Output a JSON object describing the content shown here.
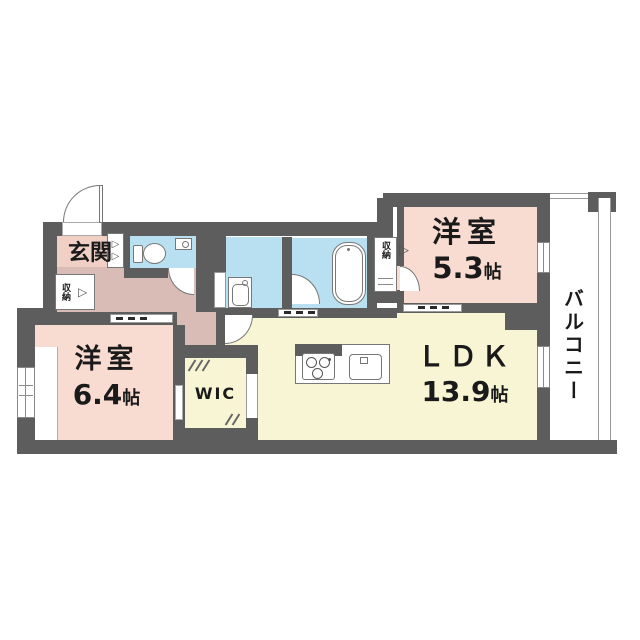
{
  "floorplan": {
    "rooms": {
      "genkan": {
        "label": "玄関"
      },
      "bedroom_small": {
        "label": "洋室",
        "size": "5.3",
        "unit": "帖"
      },
      "bedroom_large": {
        "label": "洋室",
        "size": "6.4",
        "unit": "帖"
      },
      "ldk": {
        "label": "ＬＤＫ",
        "size": "13.9",
        "unit": "帖"
      },
      "wic": {
        "label": "WIC"
      },
      "balcony": {
        "label": "バルコニー"
      },
      "hall_storage": {
        "label": "収納"
      },
      "bedroom_small_storage": {
        "label": "収納"
      }
    },
    "icons": {
      "folding_door_chevron": "▷"
    },
    "colors": {
      "wall": "#5d5d5d",
      "bedroom_pink": "#f8dcd1",
      "genkan_pink": "#f0d0c5",
      "hallway_mauve": "#d8bcb5",
      "wet_area_blue": "#b9e0f1",
      "living_yellow": "#f8f5d4",
      "outline_gray": "#8a8a8a",
      "text": "#1a1a1a"
    }
  }
}
